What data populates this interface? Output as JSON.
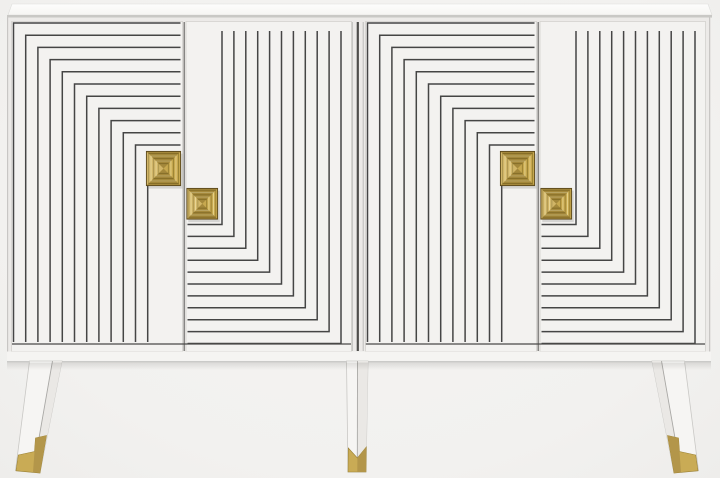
{
  "scene": {
    "kind": "product-photo",
    "subject": "white-sideboard-with-geometric-line-doors",
    "visible_text": "",
    "counts": {
      "doors": 4,
      "handles": 4,
      "legs": 3,
      "brackets_per_wide_door": 12,
      "brackets_per_rotated_door": 11
    }
  },
  "colors": {
    "background": "#f2f1ef",
    "top_face": "#fcfcfb",
    "body": "#eceae8",
    "door_panel": "#f3f2f0",
    "pattern_line": "#454545",
    "frame_line": "#4a4a48",
    "gap_line": "#6e6d6b",
    "junction_line": "#4e4d4b",
    "leg_front": "#f6f5f3",
    "leg_side": "#eae8e5",
    "gold": "#c7a84f",
    "gold_dark": "#9c8334",
    "gold_shade": "#b3964a",
    "gold_light": "#e6d189",
    "handle_outline": "#5a481c"
  },
  "patterns": [
    {
      "name": "door-1-pattern",
      "ox": 13.5,
      "oy": 23,
      "step": 12.2,
      "count": 12,
      "hEnd": 180.5,
      "vEnd": 342
    },
    {
      "name": "door-2-pattern",
      "ox": 222,
      "oy": 224.5,
      "step": 11.9,
      "count": 11,
      "hEnd": 187.5,
      "vEnd": 31
    },
    {
      "name": "door-3-pattern",
      "ox": 367.5,
      "oy": 23,
      "step": 12.2,
      "count": 12,
      "hEnd": 534.5,
      "vEnd": 342
    },
    {
      "name": "door-4-pattern",
      "ox": 576,
      "oy": 224.5,
      "step": 11.9,
      "count": 11,
      "hEnd": 541.5,
      "vEnd": 31
    }
  ],
  "handles": [
    {
      "name": "handle-door-1",
      "x": 146,
      "y": 151,
      "size": 35
    },
    {
      "name": "handle-door-2",
      "x": 186.5,
      "y": 188,
      "size": 31.5
    },
    {
      "name": "handle-door-3",
      "x": 500,
      "y": 151,
      "size": 35
    },
    {
      "name": "handle-door-4",
      "x": 540.5,
      "y": 188,
      "size": 31.5
    }
  ],
  "handle_style": {
    "rings": 5,
    "ring_gap_ratio": 0.072
  }
}
